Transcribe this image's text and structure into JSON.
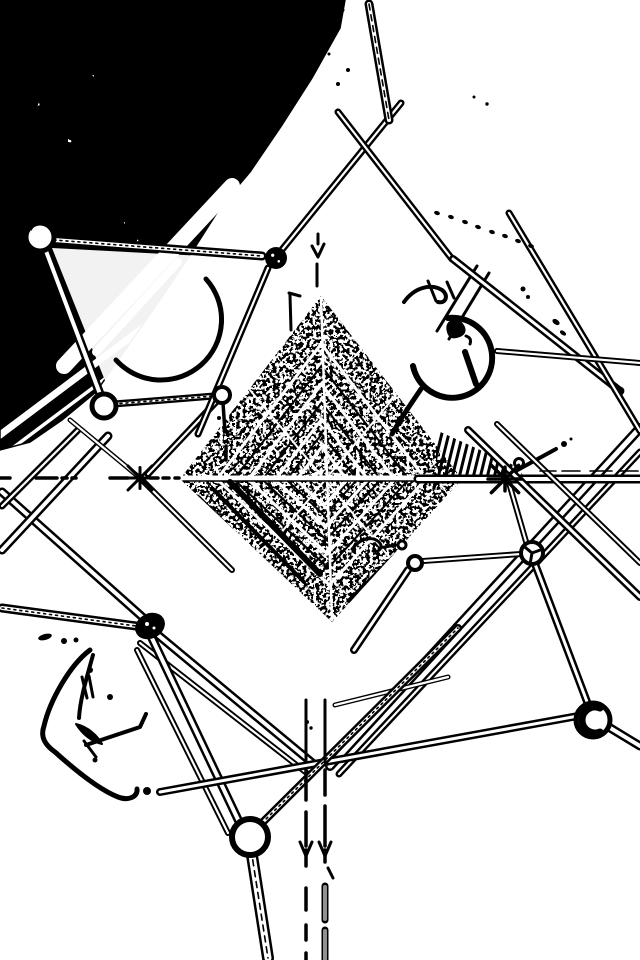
{
  "meta": {
    "description": "Edge-detected black-and-white photograph looking up inside a lattice transmission tower",
    "width": 640,
    "height": 960,
    "colors": {
      "background": "#ffffff",
      "ink": "#000000",
      "gray": "#909090",
      "softgray": "#9a9a9a"
    }
  },
  "textures": {
    "foliage": {
      "polygon": "0,0 345,0 340,28 312,78 282,125 250,172 222,205 192,252 160,300 128,346 96,392 62,420 30,442 0,450",
      "noise": {
        "baseFrequency": 0.11,
        "octaves": 3,
        "seed": 7,
        "table": "0 1 1 1 1"
      },
      "stripes": {
        "spacing": 30,
        "width": 3.5,
        "wide_every": 4,
        "wide_width": 7,
        "dx": 420,
        "dy": -315
      }
    },
    "diamond": {
      "polygon": "321,296 180,479 332,622 462,479",
      "noise": {
        "baseFrequency": 0.3,
        "octaves": 2,
        "seed": 11,
        "table": "0 0 1 1"
      },
      "gray_noise": {
        "baseFrequency": 0.5,
        "octaves": 2,
        "seed": 4,
        "table": "0 0 0 1"
      },
      "center": [
        322,
        480
      ],
      "white_diamond_scales": [
        0.74,
        0.52,
        0.33,
        0.18
      ],
      "black_diamond_scales": [
        0.62,
        0.42,
        0.25
      ],
      "white_rays": [
        [
          321,
          298,
          332,
          620,
          2.5
        ],
        [
          182,
          479,
          460,
          479,
          3
        ],
        [
          250,
          390,
          400,
          570,
          2
        ],
        [
          250,
          570,
          400,
          390,
          2
        ]
      ],
      "bars": [
        [
          198,
          498,
          288,
          588,
          6
        ],
        [
          214,
          490,
          304,
          582,
          4
        ],
        [
          230,
          482,
          320,
          574,
          6
        ],
        [
          350,
          600,
          440,
          512,
          5
        ],
        [
          366,
          592,
          448,
          508,
          3
        ],
        [
          370,
          355,
          430,
          415,
          5
        ],
        [
          385,
          345,
          442,
          402,
          3
        ]
      ],
      "hline_white": [
        183,
        477,
        460,
        477,
        3
      ],
      "hline_black": [
        183,
        481,
        460,
        481,
        1.6
      ]
    },
    "blinds": {
      "polygon": "436,430 520,468 524,479 436,479",
      "hatch": {
        "x0": 430,
        "x1": 530,
        "step": 7,
        "dx": 14,
        "y0": 425,
        "y1": 482,
        "width": 3
      }
    }
  },
  "carves": {
    "wedge": "52,248 260,259 214,392 112,398",
    "bands": [
      [
        232,
        186,
        64,
        366,
        16
      ],
      [
        178,
        262,
        96,
        352,
        8
      ]
    ]
  },
  "arcs": [
    {
      "name": "crescent",
      "d": "M206,279 A60,60 0 1 1 116,360",
      "w": 5
    },
    {
      "name": "insulator-ring",
      "d": "M448,318 A40,40 0 1 1 413,366",
      "w": 6
    },
    {
      "name": "insulator-tail",
      "d": "M421,389 C410,405 400,420 392,434",
      "w": 5
    }
  ],
  "squiggles": [
    {
      "name": "hook-claw-a",
      "d": "M404,302 C414,288 430,283 442,290 C449,295 446,304 438,302",
      "w": 4
    },
    {
      "name": "hook-spike",
      "d": "M428,281 L436,301",
      "w": 3
    },
    {
      "name": "ring-vline-a",
      "d": "M477,266 L437,331",
      "w": 3
    },
    {
      "name": "ring-vline-b",
      "d": "M489,273 L449,339",
      "w": 3
    },
    {
      "name": "ring-rod",
      "d": "M465,352 L476,384",
      "w": 6
    },
    {
      "name": "ring-rod-b",
      "d": "M447,282 L454,298",
      "w": 3
    },
    {
      "name": "ring-blob",
      "d": "M450,322 q8,-4 12,2 q6,8 -2,12 q-10,4 -12,-4 q-2,-7 2,-10 Z",
      "w": 2,
      "fill": true
    },
    {
      "name": "ring-blob-b",
      "d": "M466,336 q6,2 4,8",
      "w": 3
    },
    {
      "name": "mid-squiggle",
      "d": "M352,549 C359,540 371,535 379,542 C384,547 379,553 373,551 M379,548 L396,545",
      "w": 3
    },
    {
      "name": "bl-outer",
      "d": "M90,650 C70,665 50,700 44,726 C40,737 45,745 55,752 C75,770 100,790 118,797 C128,801 138,797 137,789",
      "w": 5
    },
    {
      "name": "bl-inner",
      "d": "M93,655 C86,680 80,700 79,718",
      "w": 4
    },
    {
      "name": "bl-tick-a",
      "d": "M82,677 L87,698",
      "w": 3
    },
    {
      "name": "bl-tick-b",
      "d": "M89,676 L93,697",
      "w": 3
    },
    {
      "name": "bl-foot",
      "d": "M76,724 C82,734 92,742 102,744 C97,735 88,727 76,724 Z",
      "w": 2,
      "fill": true
    },
    {
      "name": "bl-zig",
      "d": "M86,745 L140,727 L146,714",
      "w": 4
    },
    {
      "name": "bl-drop",
      "d": "M84,741 L96,757",
      "w": 3
    },
    {
      "name": "apex-arrow",
      "d": "M312,246 L318,257 L324,244 M317,264 L317,286 M318,234 L318,244",
      "w": 3
    },
    {
      "name": "flag-mark",
      "d": "M289,293 L300,296 M290,295 L291,330",
      "w": 3
    },
    {
      "name": "edge-tick",
      "d": "M8,210 L22,201",
      "w": 3
    },
    {
      "name": "top-dash",
      "d": "M333,25 L343,10",
      "w": 3
    },
    {
      "name": "star2-spur",
      "d": "M512,473 L556,449",
      "w": 4
    },
    {
      "name": "n4-tail",
      "d": "M223,403 L225,432 M226,446 L226,460",
      "w": 3.5
    }
  ],
  "tubes": [
    [
      152,
      630,
      316,
      766,
      9,
      0
    ],
    [
      140,
      643,
      308,
      774,
      6,
      0
    ],
    [
      330,
      766,
      640,
      428,
      10,
      0
    ],
    [
      339,
      774,
      640,
      452,
      7,
      0
    ],
    [
      150,
      634,
      242,
      828,
      9,
      0
    ],
    [
      137,
      650,
      228,
      833,
      6,
      0
    ],
    [
      160,
      792,
      589,
      714,
      8,
      0
    ],
    [
      335,
      705,
      448,
      677,
      5,
      0
    ],
    [
      2,
      492,
      148,
      622,
      9,
      0
    ],
    [
      108,
      436,
      2,
      550,
      9,
      0
    ],
    [
      78,
      430,
      2,
      506,
      7,
      0
    ],
    [
      140,
      478,
      232,
      570,
      6,
      0
    ],
    [
      140,
      478,
      70,
      420,
      5,
      0
    ],
    [
      216,
      402,
      148,
      474,
      7,
      0
    ],
    [
      114,
      404,
      214,
      396,
      7,
      1
    ],
    [
      54,
      240,
      262,
      256,
      9,
      1
    ],
    [
      46,
      251,
      100,
      394,
      9,
      0
    ],
    [
      268,
      268,
      198,
      434,
      7,
      0
    ],
    [
      272,
      262,
      401,
      103,
      7,
      0
    ],
    [
      338,
      112,
      452,
      259,
      7,
      0
    ],
    [
      369,
      4,
      389,
      120,
      9,
      3
    ],
    [
      453,
      259,
      620,
      391,
      8,
      2
    ],
    [
      509,
      213,
      640,
      431,
      7,
      0
    ],
    [
      497,
      351,
      640,
      363,
      6,
      0
    ],
    [
      418,
      479,
      640,
      479,
      9,
      0
    ],
    [
      468,
      430,
      640,
      597,
      8,
      0
    ],
    [
      497,
      424,
      640,
      563,
      6,
      0
    ],
    [
      527,
      545,
      509,
      483,
      6,
      0
    ],
    [
      423,
      561,
      521,
      554,
      6,
      0
    ],
    [
      408,
      570,
      354,
      650,
      8,
      0
    ],
    [
      535,
      564,
      589,
      707,
      8,
      0
    ],
    [
      607,
      726,
      640,
      746,
      9,
      0
    ],
    [
      2,
      608,
      136,
      626,
      9,
      1
    ],
    [
      262,
      823,
      458,
      628,
      8,
      1
    ],
    [
      251,
      849,
      268,
      958,
      12,
      3
    ]
  ],
  "nodes": {
    "rings": [
      [
        40,
        237,
        14,
        5
      ],
      [
        104,
        406,
        12,
        5
      ],
      [
        222,
        395,
        8,
        4
      ],
      [
        250,
        837,
        18,
        6
      ],
      [
        593,
        720,
        17,
        5
      ],
      [
        415,
        563,
        7,
        4
      ],
      [
        402,
        545,
        4,
        3
      ],
      [
        519,
        463,
        4.5,
        3
      ]
    ],
    "blobs": [
      [
        276,
        258,
        11
      ],
      [
        104,
        406,
        7
      ]
    ],
    "ellipse_blob": {
      "cx": 150,
      "cy": 626,
      "rx": 13,
      "ry": 10,
      "rot": -28,
      "sw": 5
    },
    "wheel": {
      "cx": 532,
      "cy": 553,
      "r": 11,
      "sw": 4,
      "spoke_angles": [
        100,
        220,
        340
      ]
    },
    "n7_c": {
      "d": "M600,708 A13,13 0 1 0 600,732",
      "w": 7
    },
    "n1_inner": {
      "d": "M30,230 A12,12 0 0 1 50,228",
      "w": 3
    }
  },
  "stars": [
    {
      "cx": 140,
      "cy": 478,
      "len": 15,
      "w": 3
    },
    {
      "cx": 505,
      "cy": 479,
      "len": 17,
      "w": 3.5
    }
  ],
  "dash_rows": [
    {
      "y": 478,
      "w": 3.5,
      "segs": [
        [
          0,
          10
        ],
        [
          36,
          57
        ],
        [
          62,
          67
        ],
        [
          72,
          76
        ],
        [
          110,
          128
        ],
        [
          150,
          158
        ],
        [
          163,
          169
        ],
        [
          175,
          179
        ]
      ]
    },
    {
      "y": 229,
      "w": 3,
      "segs": [
        [
          0,
          14
        ]
      ]
    },
    {
      "y": 243,
      "w": 3,
      "segs": [
        [
          0,
          8
        ]
      ]
    },
    {
      "y": 471,
      "w": 1.6,
      "segs": [
        [
          540,
          556
        ],
        [
          562,
          580
        ],
        [
          590,
          612
        ],
        [
          620,
          638
        ]
      ]
    }
  ],
  "verticals": {
    "thin_pairs": [
      [
        306,
        700,
        762
      ],
      [
        325,
        700,
        762
      ]
    ],
    "left_x": 306,
    "left_segs": [
      [
        770,
        800
      ],
      [
        812,
        846
      ],
      [
        850,
        866
      ],
      [
        888,
        910
      ],
      [
        925,
        940
      ],
      [
        953,
        960
      ]
    ],
    "right_x": 325,
    "right_black_segs": [
      [
        770,
        795
      ],
      [
        806,
        846
      ],
      [
        850,
        862
      ]
    ],
    "right_gray_segs": [
      [
        886,
        920
      ],
      [
        930,
        960
      ]
    ],
    "y_splits": [
      [
        300,
        842,
        306,
        856
      ],
      [
        312,
        842,
        306,
        856
      ],
      [
        319,
        842,
        325,
        856
      ],
      [
        331,
        842,
        325,
        856
      ]
    ],
    "hook": [
      328,
      868,
      333,
      878
    ]
  },
  "dots": [
    [
      348,
      70,
      2
    ],
    [
      338,
      84,
      2
    ],
    [
      329,
      54,
      1.5
    ],
    [
      523,
      289,
      2.5
    ],
    [
      528,
      297,
      2
    ],
    [
      64,
      641,
      3
    ],
    [
      76,
      640,
      2.5
    ],
    [
      90,
      670,
      3
    ],
    [
      147,
      791,
      4
    ],
    [
      95,
      760,
      2.5
    ],
    [
      110,
      697,
      3
    ],
    [
      219,
      418,
      2
    ],
    [
      564,
      444,
      3
    ],
    [
      571,
      439,
      1.5
    ],
    [
      307,
      722,
      2
    ],
    [
      311,
      728,
      1.7
    ],
    [
      487,
      104,
      1.7
    ],
    [
      474,
      97,
      1.5
    ]
  ],
  "ovals": [
    [
      45,
      637,
      7,
      3,
      -15
    ],
    [
      556,
      322,
      4,
      2.5,
      35
    ],
    [
      563,
      333,
      3.5,
      2,
      35
    ],
    [
      437,
      213,
      3,
      2,
      20
    ],
    [
      451,
      217,
      3,
      2,
      20
    ],
    [
      465,
      222,
      3,
      2,
      20
    ],
    [
      478,
      227,
      3,
      2,
      20
    ],
    [
      492,
      232,
      3,
      2,
      20
    ],
    [
      505,
      236,
      3,
      2,
      20
    ],
    [
      518,
      241,
      3,
      2,
      20
    ],
    [
      531,
      246,
      3,
      2,
      20
    ]
  ]
}
